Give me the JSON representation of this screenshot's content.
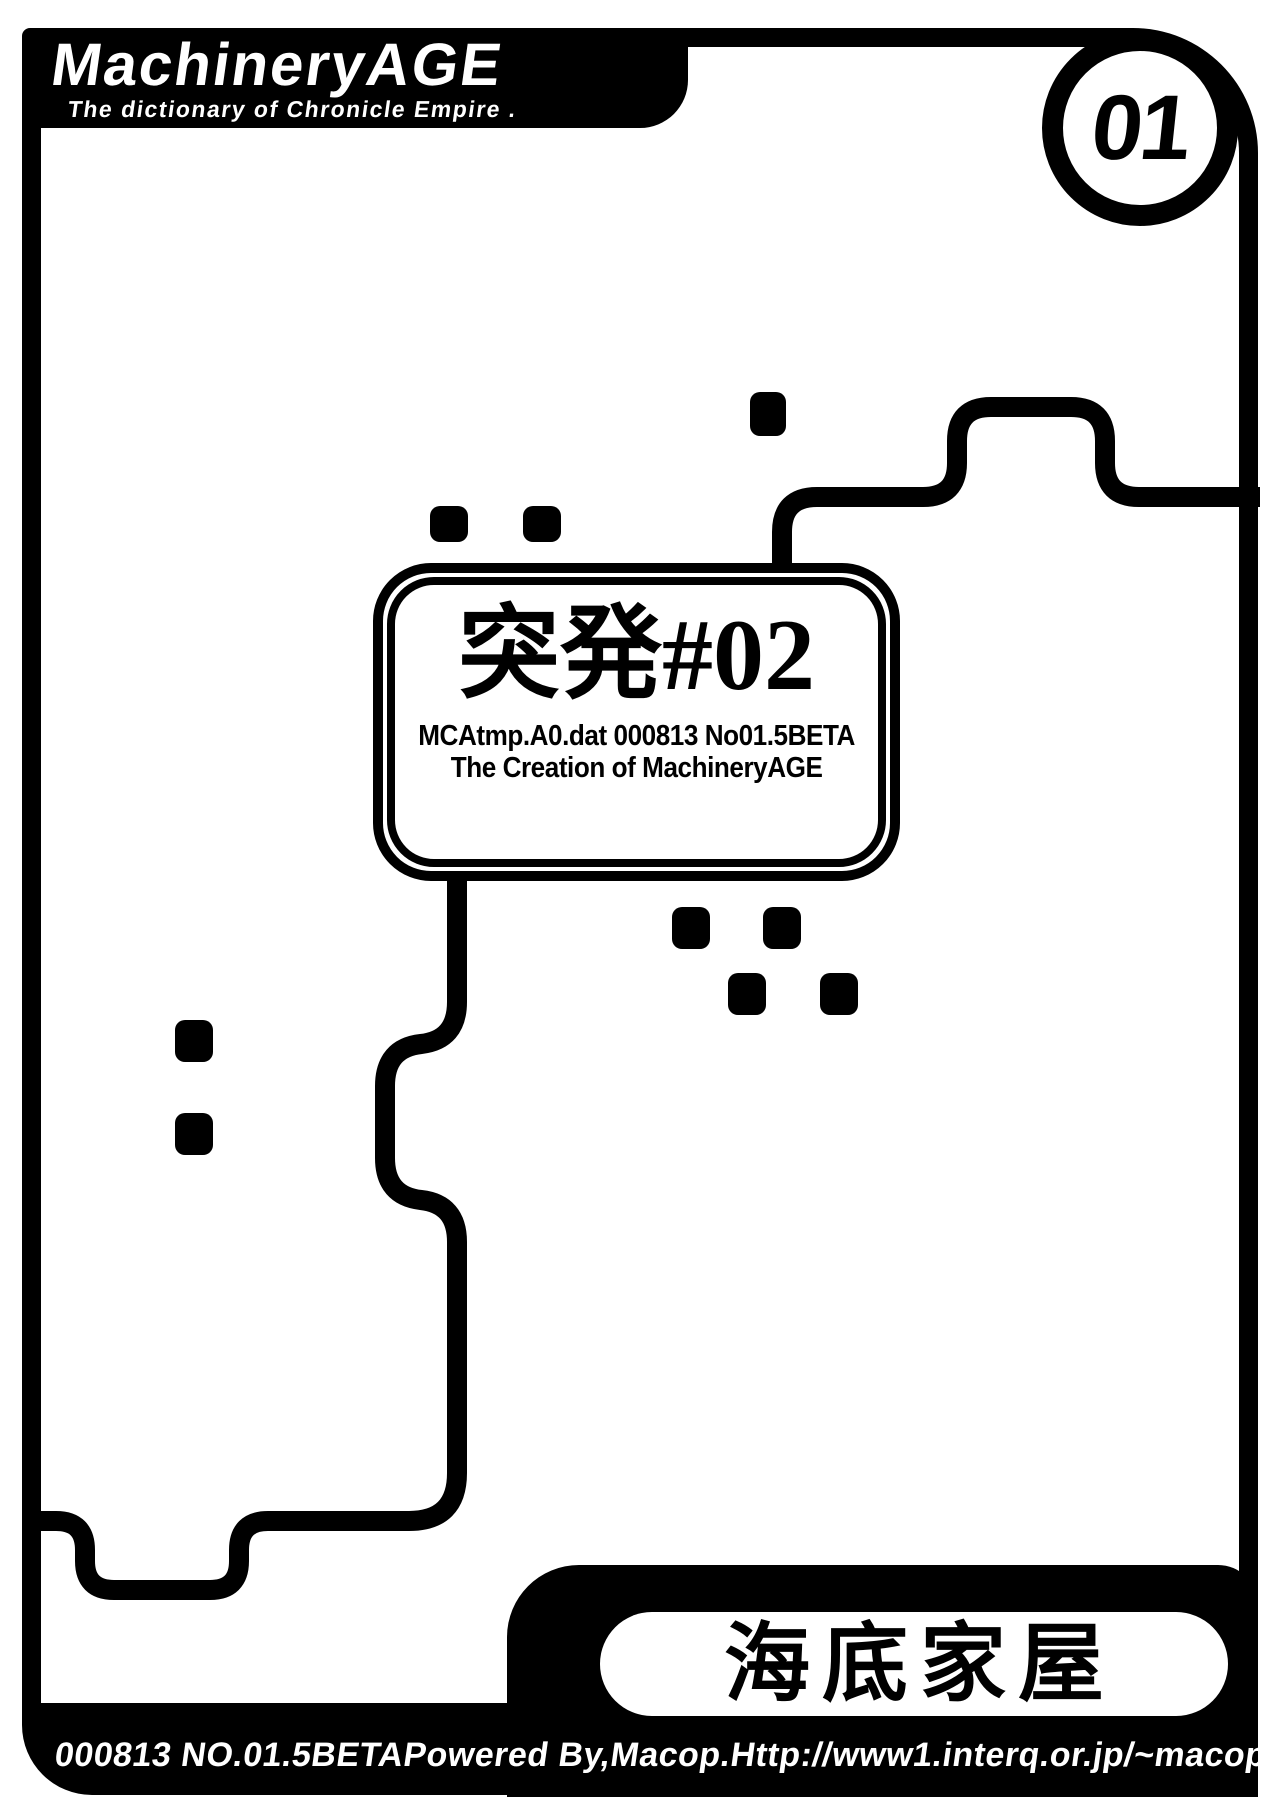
{
  "page": {
    "logo": {
      "title": "MachineryAGE",
      "subtitle": "The dictionary of Chronicle Empire ."
    },
    "page_badge": "01",
    "center_box": {
      "title": "突発#02",
      "subtitle1": "MCAtmp.A0.dat 000813 No01.5BETA",
      "subtitle2": "The Creation of MachineryAGE"
    },
    "bottom_box": {
      "title": "海底家屋"
    },
    "footer": {
      "part1": "000813 NO.01.5BETA",
      "part2": "Powered By,Macop.",
      "part3": "Http://www1.interq.or.jp/~macop/"
    },
    "colors": {
      "ink": "#000000",
      "paper": "#ffffff"
    }
  }
}
